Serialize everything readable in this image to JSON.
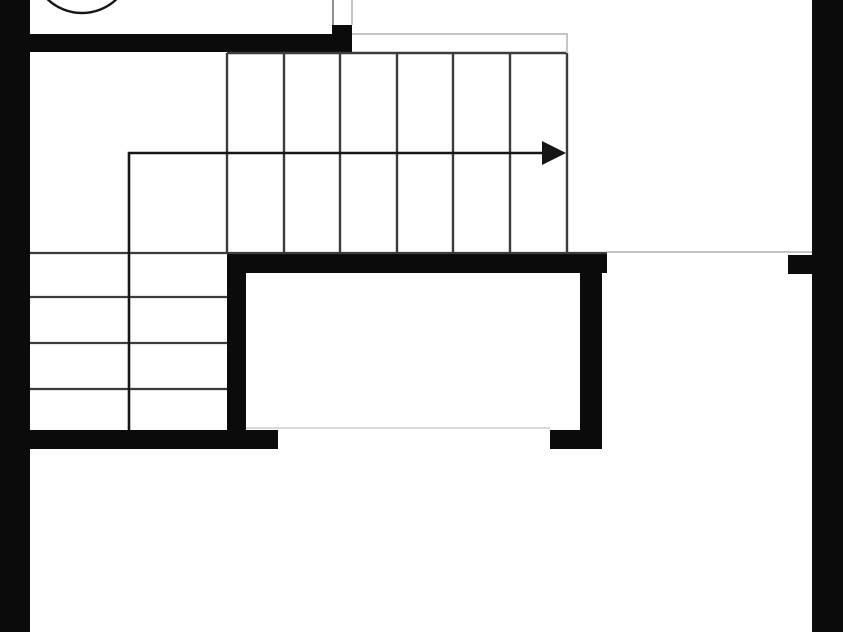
{
  "meta": {
    "title": "architectural floor plan — stair detail",
    "drawing_type": "black and white floor plan, plan view"
  },
  "canvas": {
    "width": 843,
    "height": 632,
    "background": "#ffffff"
  },
  "colors": {
    "wall": "#0b0b0b",
    "tread": "#3c3c3c",
    "arrow": "#161616",
    "outline_light": "#c6c6c6",
    "outline_mid": "#8f8f8f",
    "edge_faint": "#d4d4d4"
  },
  "walls": [
    {
      "name": "wall-exterior-left",
      "x": 0,
      "y": 0,
      "w": 30,
      "h": 632
    },
    {
      "name": "wall-exterior-right",
      "x": 812,
      "y": 0,
      "w": 31,
      "h": 632
    },
    {
      "name": "wall-top",
      "x": 0,
      "y": 34,
      "w": 352,
      "h": 18
    },
    {
      "name": "wall-top-end-pier",
      "x": 332,
      "y": 25,
      "w": 20,
      "h": 28
    },
    {
      "name": "wall-room-top",
      "x": 227,
      "y": 254,
      "w": 380,
      "h": 19
    },
    {
      "name": "wall-room-left",
      "x": 227,
      "y": 254,
      "w": 19,
      "h": 177
    },
    {
      "name": "wall-room-right",
      "x": 580,
      "y": 254,
      "w": 22,
      "h": 195
    },
    {
      "name": "wall-bottom-left",
      "x": 0,
      "y": 430,
      "w": 278,
      "h": 19
    },
    {
      "name": "wall-room-bottom-right-stub",
      "x": 550,
      "y": 430,
      "w": 52,
      "h": 19
    },
    {
      "name": "wall-right-door-tab",
      "x": 788,
      "y": 255,
      "w": 24,
      "h": 19
    }
  ],
  "thin_lines": [
    {
      "name": "stair-top-edge-line",
      "x1": 227,
      "y1": 53,
      "x2": 568,
      "y2": 53,
      "w": 2.4,
      "color": "tread"
    },
    {
      "name": "stair-landing-outline-top",
      "x1": 352,
      "y1": 34,
      "x2": 568,
      "y2": 34,
      "w": 2,
      "color": "outline_light"
    },
    {
      "name": "stair-landing-outline-right",
      "x1": 567,
      "y1": 34,
      "x2": 567,
      "y2": 53,
      "w": 2,
      "color": "outline_light"
    },
    {
      "name": "top-opening-jamb-left",
      "x1": 333,
      "y1": 0,
      "x2": 333,
      "y2": 25,
      "w": 2,
      "color": "outline_mid"
    },
    {
      "name": "top-opening-jamb-right",
      "x1": 352,
      "y1": 0,
      "x2": 352,
      "y2": 25,
      "w": 2,
      "color": "outline_light"
    },
    {
      "name": "lower-stair-top-edge-line",
      "x1": 30,
      "y1": 253,
      "x2": 607,
      "y2": 253,
      "w": 2.2,
      "color": "tread"
    },
    {
      "name": "hall-opening-line",
      "x1": 607,
      "y1": 252,
      "x2": 812,
      "y2": 252,
      "w": 2,
      "color": "outline_light"
    },
    {
      "name": "room-bottom-opening-line",
      "x1": 246,
      "y1": 428,
      "x2": 550,
      "y2": 428,
      "w": 1.8,
      "color": "edge_faint"
    }
  ],
  "stairs": {
    "upper_flight": {
      "name": "upper-stair-flight",
      "run": "horizontal",
      "tread_x": [
        227,
        284,
        340,
        397,
        453,
        510,
        567
      ],
      "y1": 53,
      "y2": 253,
      "line_width": 2.4
    },
    "lower_flight": {
      "name": "lower-stair-flight",
      "run": "vertical",
      "tread_y": [
        297,
        343,
        389
      ],
      "x1": 30,
      "x2": 227,
      "line_width": 2.2
    }
  },
  "direction_arrow": {
    "name": "stair-direction-arrow",
    "path": [
      [
        129,
        430
      ],
      [
        129,
        153
      ],
      [
        553,
        153
      ]
    ],
    "head": [
      [
        542,
        141
      ],
      [
        566,
        153
      ],
      [
        542,
        165
      ]
    ],
    "line_width": 2.6
  },
  "fixture_circle": {
    "name": "door-swing-circle",
    "cx": 82,
    "cy": -37,
    "r": 50,
    "stroke_width": 2.4
  }
}
